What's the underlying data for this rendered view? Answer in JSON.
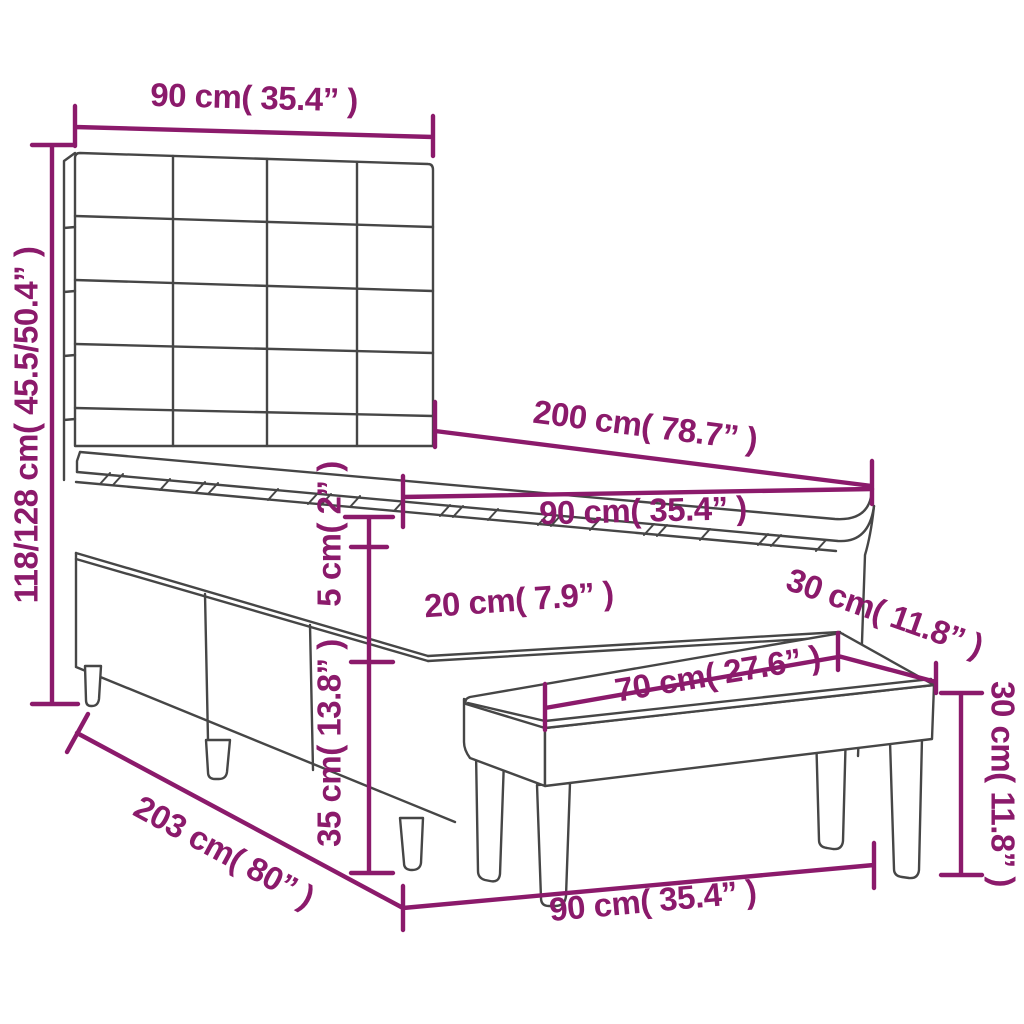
{
  "diagram": {
    "type": "furniture-dimension-diagram",
    "subject": "box spring bed with square-tufted headboard, mattress topper and bench",
    "colors": {
      "dimension": "#8B1A6B",
      "line_art": "#464646",
      "background": "#FFFFFF"
    },
    "dimensions": [
      {
        "id": "headboard-width",
        "text": "90 cm( 35.4” )"
      },
      {
        "id": "headboard-height",
        "text": "118/128 cm( 45.5/50.4” )"
      },
      {
        "id": "bed-length",
        "text": "200 cm( 78.7” )"
      },
      {
        "id": "mattress-width",
        "text": "90 cm( 35.4” )"
      },
      {
        "id": "topper-thickness",
        "text": "5 cm( 2” )"
      },
      {
        "id": "mattress-thickness",
        "text": "20 cm( 7.9” )"
      },
      {
        "id": "base-height",
        "text": "35 cm( 13.8” )"
      },
      {
        "id": "bench-seat-length",
        "text": "70 cm( 27.6” )"
      },
      {
        "id": "bench-depth",
        "text": "30 cm( 11.8” )"
      },
      {
        "id": "bench-height",
        "text": "30 cm( 11.8” )"
      },
      {
        "id": "total-length",
        "text": "203 cm( 80” )"
      },
      {
        "id": "bench-length",
        "text": "90 cm( 35.4” )"
      }
    ]
  }
}
